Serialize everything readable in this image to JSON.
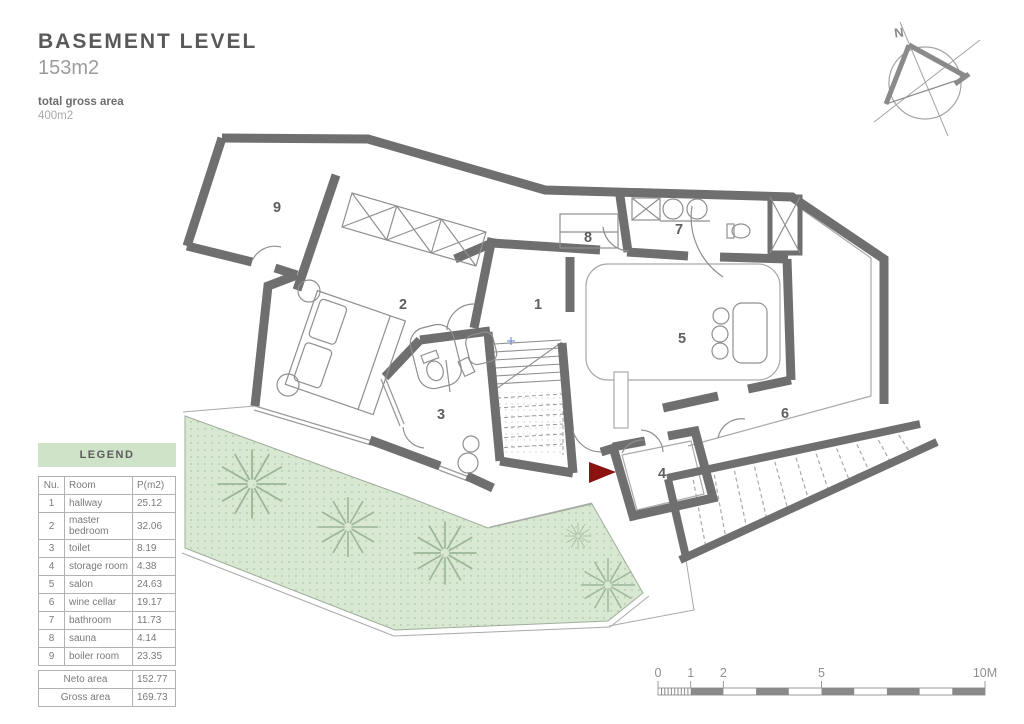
{
  "title_block": {
    "title": "BASEMENT LEVEL",
    "area": "153m2",
    "gross_label": "total gross area",
    "gross_value": "400m2"
  },
  "legend": {
    "header": "LEGEND",
    "columns": {
      "nu": "Nu.",
      "room": "Room",
      "area": "P(m2)"
    },
    "rows": [
      {
        "nu": "1",
        "room": "hallway",
        "area": "25.12"
      },
      {
        "nu": "2",
        "room": "master bedroom",
        "area": "32.06"
      },
      {
        "nu": "3",
        "room": "toilet",
        "area": "8.19"
      },
      {
        "nu": "4",
        "room": "storage room",
        "area": "4.38"
      },
      {
        "nu": "5",
        "room": "salon",
        "area": "24.63"
      },
      {
        "nu": "6",
        "room": "wine cellar",
        "area": "19.17"
      },
      {
        "nu": "7",
        "room": "bathroom",
        "area": "11.73"
      },
      {
        "nu": "8",
        "room": "sauna",
        "area": "4.14"
      },
      {
        "nu": "9",
        "room": "boiler room",
        "area": "23.35"
      }
    ],
    "totals": [
      {
        "label": "Neto area",
        "value": "152.77"
      },
      {
        "label": "Gross area",
        "value": "169.73"
      }
    ]
  },
  "plan": {
    "room_labels": [
      "1",
      "2",
      "3",
      "4",
      "5",
      "6",
      "7",
      "8",
      "9"
    ],
    "colors": {
      "wall": "#6f6f6f",
      "thin_line": "#8f8f8f",
      "terrace_fill": "#d9e8d2",
      "terrace_dot": "#afc7a9",
      "entrance_arrow": "#8c1212",
      "legend_header_bg": "#cfe3c9"
    }
  },
  "compass": {
    "north_label": "N"
  },
  "scale_bar": {
    "labels": [
      "0",
      "1",
      "2",
      "5",
      "10M"
    ]
  }
}
